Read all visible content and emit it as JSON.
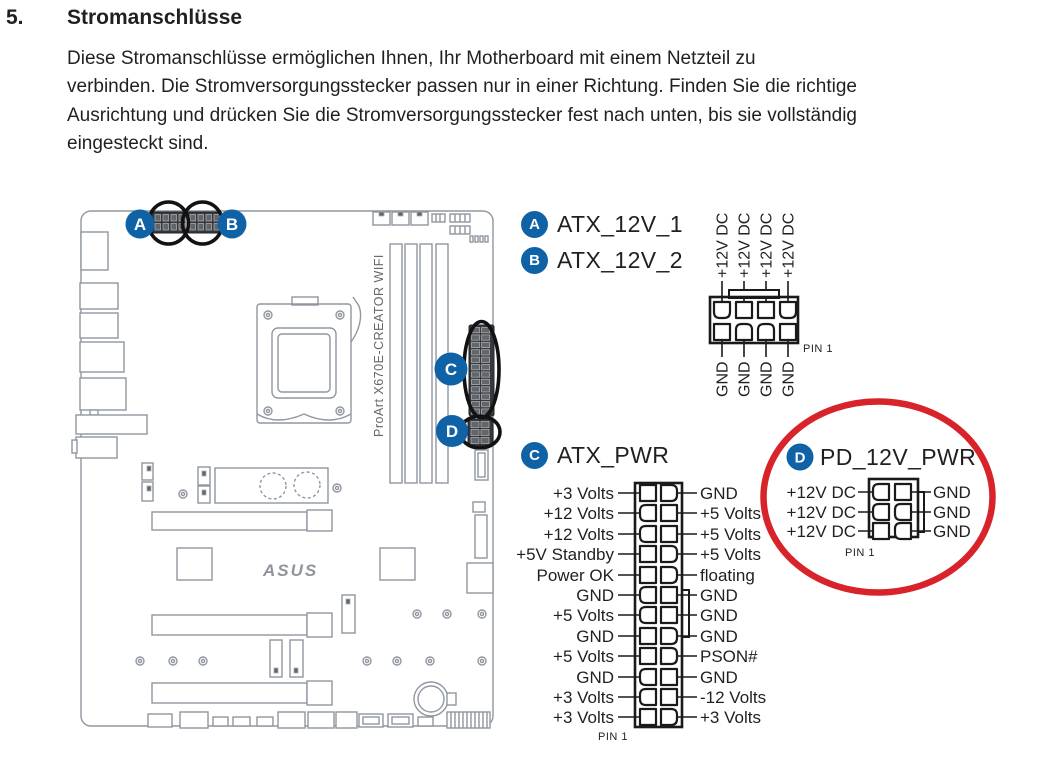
{
  "page": {
    "section_number": "5.",
    "title": "Stromanschlüsse",
    "body_lines": [
      "Diese Stromanschlüsse ermöglichen Ihnen, Ihr Motherboard mit einem Netzteil zu",
      "verbinden. Die Stromversorgungsstecker passen nur in einer Richtung. Finden Sie die richtige",
      "Ausrichtung und drücken Sie die Stromversorgungsstecker fest nach unten, bis sie vollständig",
      "eingesteckt sind."
    ]
  },
  "board": {
    "model_label": "ProArt X670E-CREATOR WIFI",
    "brand_logo": "ASUS",
    "callouts": {
      "a": "A",
      "b": "B",
      "c": "C",
      "d": "D"
    }
  },
  "connectors": {
    "atx12v": {
      "badge_a": "A",
      "label_a": "ATX_12V_1",
      "badge_b": "B",
      "label_b": "ATX_12V_2",
      "top_pins": [
        "+12V DC",
        "+12V DC",
        "+12V DC",
        "+12V DC"
      ],
      "bottom_pins": [
        "GND",
        "GND",
        "GND",
        "GND"
      ],
      "pin1": "PIN 1"
    },
    "atx_pwr": {
      "badge": "C",
      "label": "ATX_PWR",
      "left_pins": [
        "+3 Volts",
        "+12 Volts",
        "+12 Volts",
        "+5V Standby",
        "Power OK",
        "GND",
        "+5 Volts",
        "GND",
        "+5 Volts",
        "GND",
        "+3 Volts",
        "+3 Volts"
      ],
      "right_pins": [
        "GND",
        "+5 Volts",
        "+5 Volts",
        "+5 Volts",
        "floating",
        "GND",
        "GND",
        "GND",
        "PSON#",
        "GND",
        "-12 Volts",
        "+3 Volts"
      ],
      "pin1": "PIN 1"
    },
    "pd_12v_pwr": {
      "badge": "D",
      "label": "PD_12V_PWR",
      "left_pins": [
        "+12V DC",
        "+12V DC",
        "+12V DC"
      ],
      "right_pins": [
        "GND",
        "GND",
        "GND"
      ],
      "pin1": "PIN 1"
    }
  },
  "colors": {
    "badge_blue": "#0f62a6",
    "highlight_red": "#d9232a",
    "callout_ring_black": "#121212"
  }
}
